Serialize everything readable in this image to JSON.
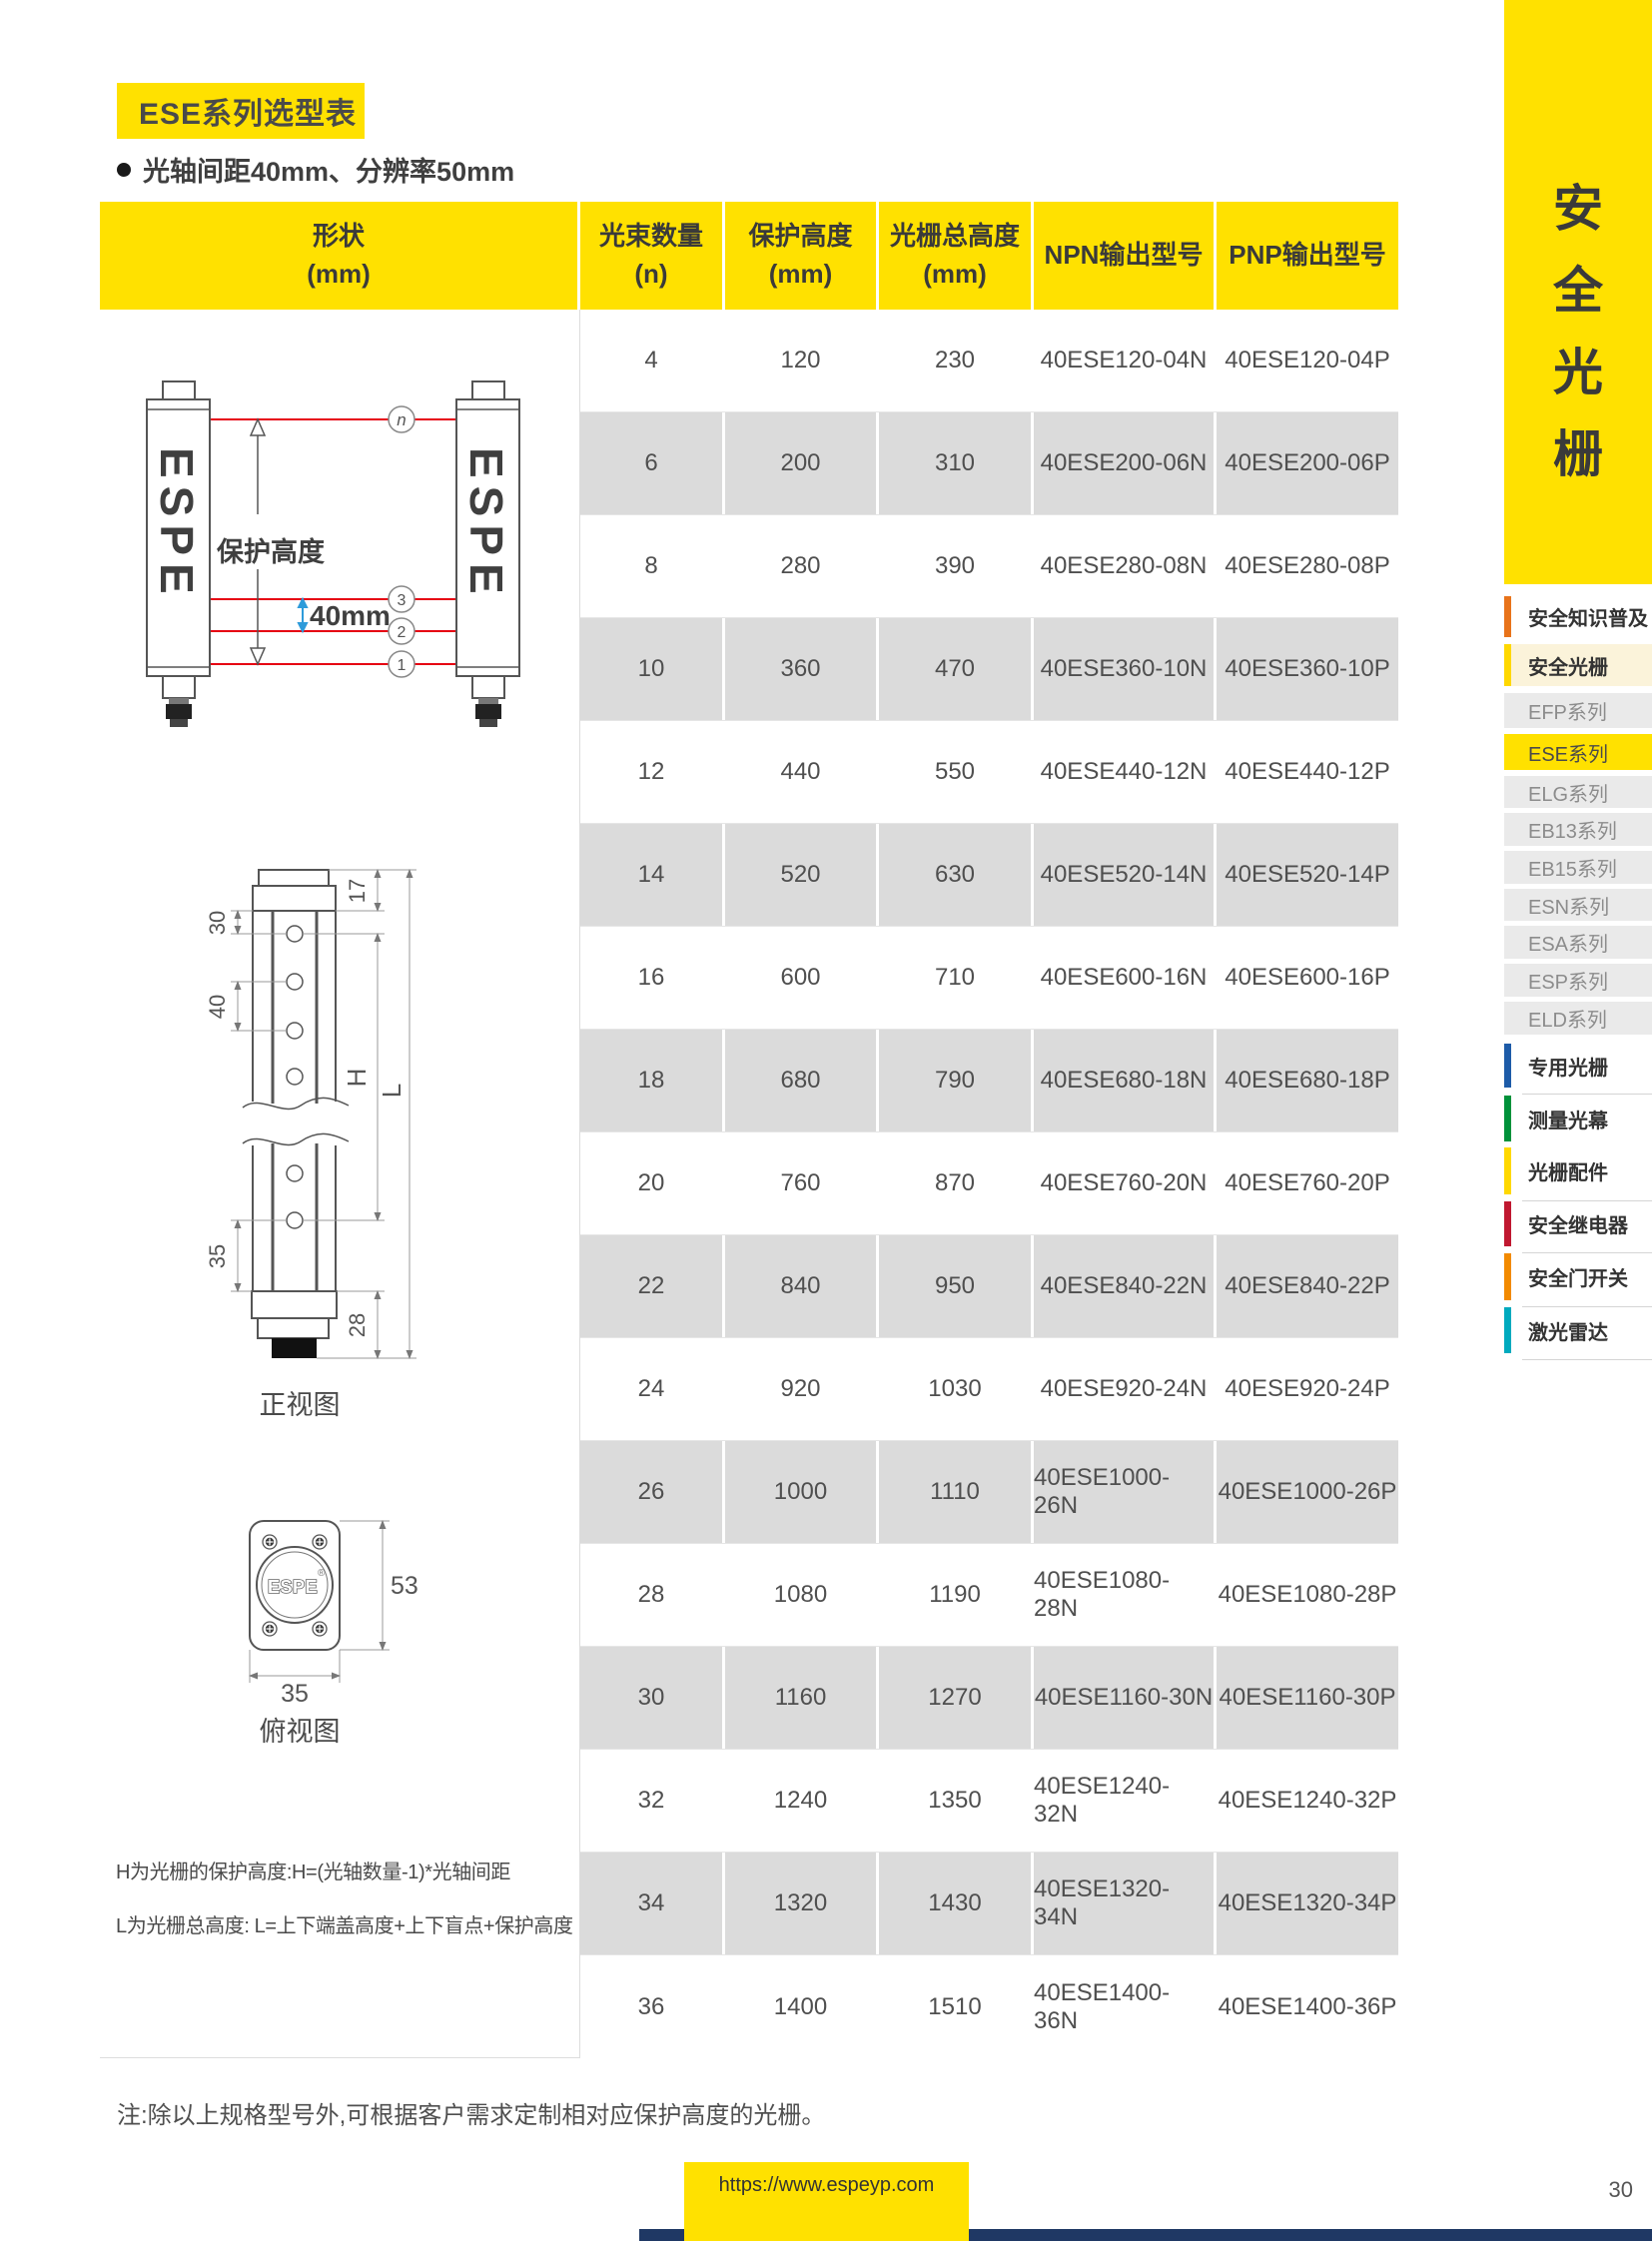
{
  "page": {
    "title": "ESE系列选型表",
    "subtitle": "光轴间距40mm、分辨率50mm",
    "bottom_note": "注:除以上规格型号外,可根据客户需求定制相对应保护高度的光栅。",
    "footer_url": "https://www.espeyp.com",
    "page_number": "30",
    "accent_yellow": "#FFE100",
    "navy": "#1F3864"
  },
  "table": {
    "headers": [
      {
        "line1": "形状",
        "line2": "(mm)"
      },
      {
        "line1": "光束数量",
        "line2": "(n)"
      },
      {
        "line1": "保护高度",
        "line2": "(mm)"
      },
      {
        "line1": "光栅总高度",
        "line2": "(mm)"
      },
      {
        "line1": "NPN输出型号",
        "line2": ""
      },
      {
        "line1": "PNP输出型号",
        "line2": ""
      }
    ],
    "rows": [
      [
        "4",
        "120",
        "230",
        "40ESE120-04N",
        "40ESE120-04P"
      ],
      [
        "6",
        "200",
        "310",
        "40ESE200-06N",
        "40ESE200-06P"
      ],
      [
        "8",
        "280",
        "390",
        "40ESE280-08N",
        "40ESE280-08P"
      ],
      [
        "10",
        "360",
        "470",
        "40ESE360-10N",
        "40ESE360-10P"
      ],
      [
        "12",
        "440",
        "550",
        "40ESE440-12N",
        "40ESE440-12P"
      ],
      [
        "14",
        "520",
        "630",
        "40ESE520-14N",
        "40ESE520-14P"
      ],
      [
        "16",
        "600",
        "710",
        "40ESE600-16N",
        "40ESE600-16P"
      ],
      [
        "18",
        "680",
        "790",
        "40ESE680-18N",
        "40ESE680-18P"
      ],
      [
        "20",
        "760",
        "870",
        "40ESE760-20N",
        "40ESE760-20P"
      ],
      [
        "22",
        "840",
        "950",
        "40ESE840-22N",
        "40ESE840-22P"
      ],
      [
        "24",
        "920",
        "1030",
        "40ESE920-24N",
        "40ESE920-24P"
      ],
      [
        "26",
        "1000",
        "1110",
        "40ESE1000-26N",
        "40ESE1000-26P"
      ],
      [
        "28",
        "1080",
        "1190",
        "40ESE1080-28N",
        "40ESE1080-28P"
      ],
      [
        "30",
        "1160",
        "1270",
        "40ESE1160-30N",
        "40ESE1160-30P"
      ],
      [
        "32",
        "1240",
        "1350",
        "40ESE1240-32N",
        "40ESE1240-32P"
      ],
      [
        "34",
        "1320",
        "1430",
        "40ESE1320-34N",
        "40ESE1320-34P"
      ],
      [
        "36",
        "1400",
        "1510",
        "40ESE1400-36N",
        "40ESE1400-36P"
      ]
    ]
  },
  "diagrams": {
    "beam": {
      "brand": "ESPE",
      "protection_height_label": "保护高度",
      "pitch_label": "40mm",
      "beam_labels": [
        "n",
        "3",
        "2",
        "1"
      ],
      "beam_color": "#E60012",
      "pitch_arrow_color": "#2E9BDA"
    },
    "front_view": {
      "caption": "正视图",
      "dims": {
        "top_cap": "17",
        "top_blind": "30",
        "pitch": "40",
        "h": "H",
        "l": "L",
        "bottom_blind": "35",
        "bottom_cap": "28"
      }
    },
    "top_view": {
      "caption": "俯视图",
      "brand": "ESPE",
      "reg": "®",
      "height": "53",
      "width": "35"
    },
    "formula_h": "H为光栅的保护高度:H=(光轴数量-1)*光轴间距",
    "formula_l": "L为光栅总高度: L=上下端盖高度+上下盲点+保护高度"
  },
  "sidebar": {
    "vertical_title": "安全光栅",
    "items": [
      {
        "label": "安全知识普及",
        "bar_color": "#E8731A"
      },
      {
        "label": "安全光栅",
        "bar_color": "#FFD800"
      },
      {
        "label": "EFP系列"
      },
      {
        "label": "ESE系列"
      },
      {
        "label": "ELG系列"
      },
      {
        "label": "EB13系列"
      },
      {
        "label": "EB15系列"
      },
      {
        "label": "ESN系列"
      },
      {
        "label": "ESA系列"
      },
      {
        "label": "ESP系列"
      },
      {
        "label": "ELD系列"
      },
      {
        "label": "专用光栅",
        "bar_color": "#1D5BA8"
      },
      {
        "label": "测量光幕",
        "bar_color": "#00913A"
      },
      {
        "label": "光栅配件",
        "bar_color": "#FFD800"
      },
      {
        "label": "安全继电器",
        "bar_color": "#C01830"
      },
      {
        "label": "安全门开关",
        "bar_color": "#F28A00"
      },
      {
        "label": "激光雷达",
        "bar_color": "#00AABE"
      }
    ]
  }
}
